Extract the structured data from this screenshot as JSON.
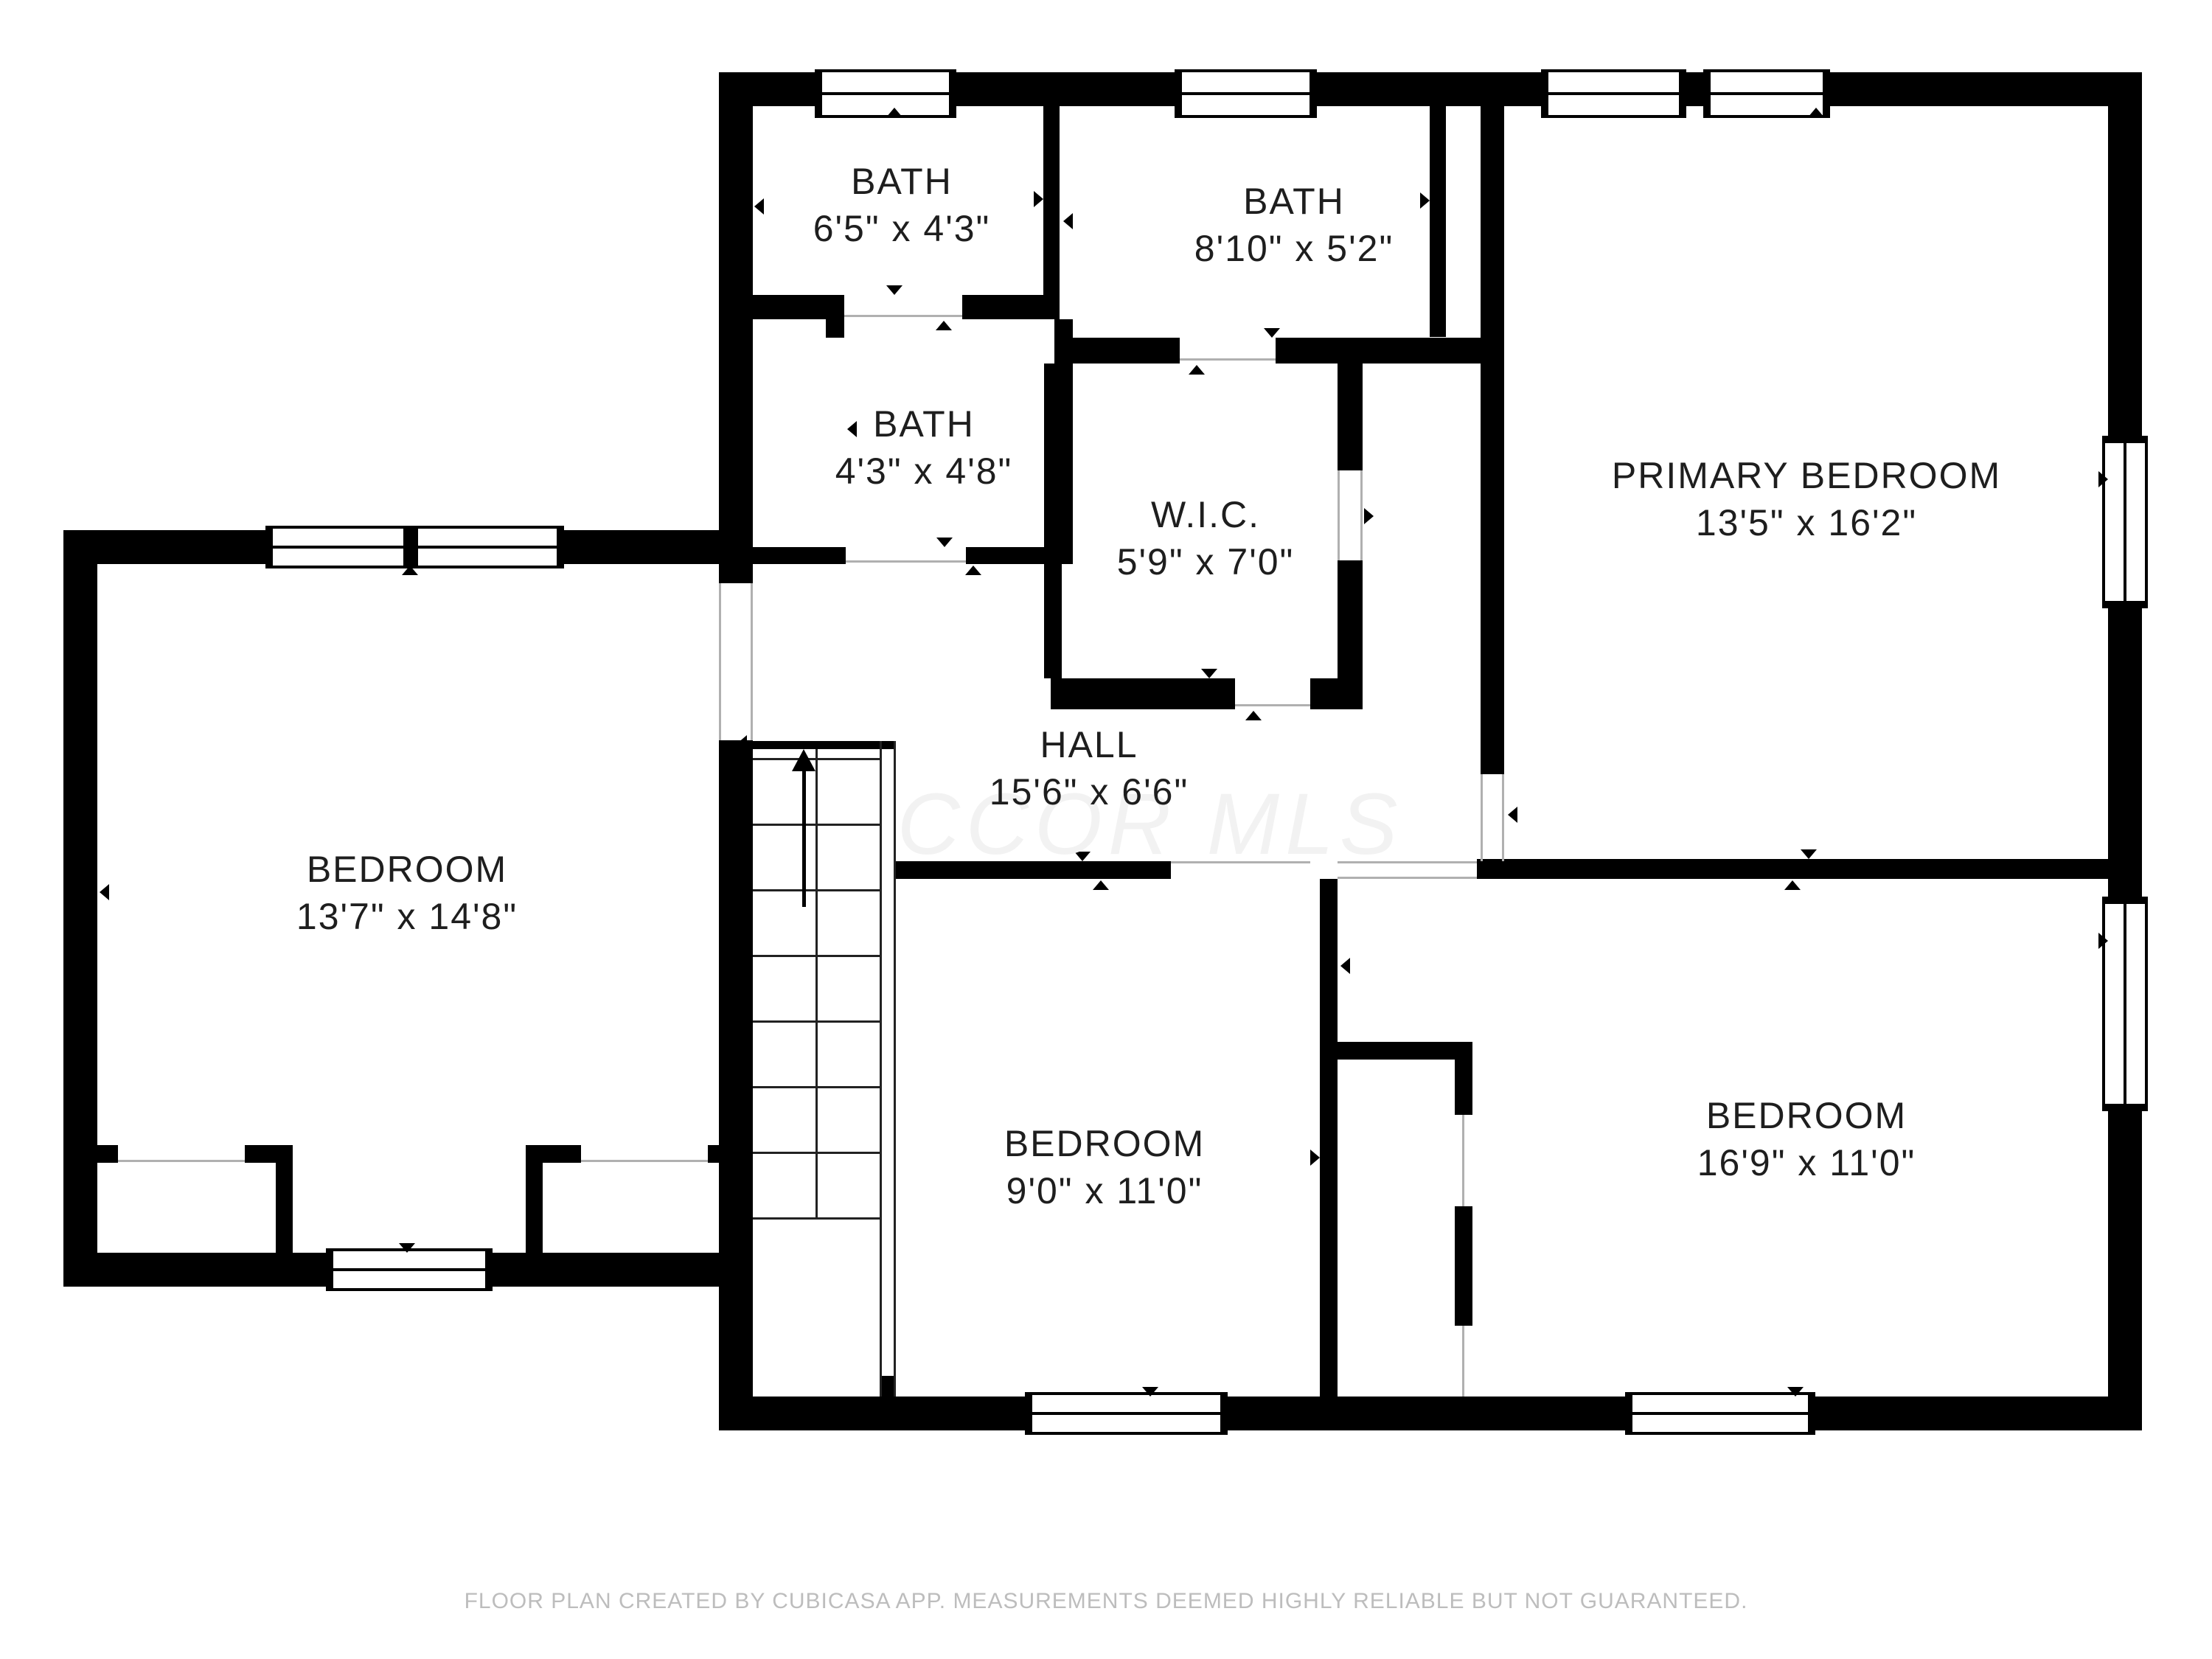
{
  "rooms": {
    "bath_top_left": {
      "name": "BATH",
      "dims": "6'5\" x 4'3\""
    },
    "bath_top_middle": {
      "name": "BATH",
      "dims": "8'10\" x 5'2\""
    },
    "bath_middle": {
      "name": "BATH",
      "dims": "4'3\" x 4'8\""
    },
    "wic": {
      "name": "W.I.C.",
      "dims": "5'9\" x 7'0\""
    },
    "primary_bedroom": {
      "name": "PRIMARY BEDROOM",
      "dims": "13'5\" x 16'2\""
    },
    "hall": {
      "name": "HALL",
      "dims": "15'6\" x 6'6\""
    },
    "bedroom_left": {
      "name": "BEDROOM",
      "dims": "13'7\" x 14'8\""
    },
    "bedroom_bottom_middle": {
      "name": "BEDROOM",
      "dims": "9'0\" x 11'0\""
    },
    "bedroom_bottom_right": {
      "name": "BEDROOM",
      "dims": "16'9\" x 11'0\""
    }
  },
  "watermark": "CCOR MLS",
  "footer": "FLOOR PLAN CREATED BY CUBICASA APP. MEASUREMENTS DEEMED HIGHLY RELIABLE BUT NOT GUARANTEED.",
  "colors": {
    "wall": "#000000",
    "label": "#1e1e1e",
    "watermark": "#f2f2f2",
    "footer": "#bdbdbd",
    "thin_line": "#b0b0b0"
  }
}
